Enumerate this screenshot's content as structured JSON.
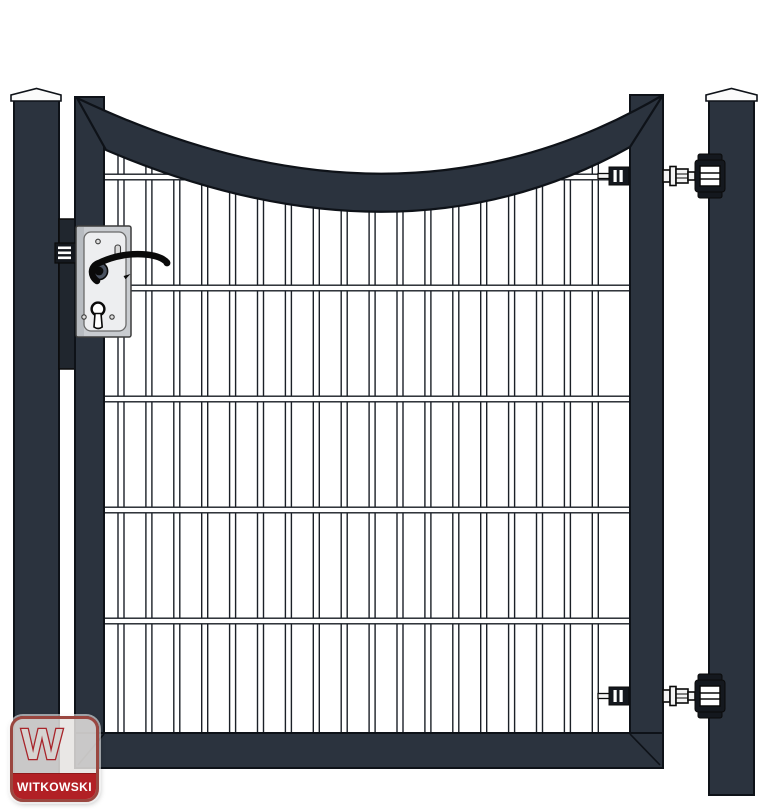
{
  "brand": {
    "name": "WITKOWSKI",
    "logo_letter": "W"
  },
  "scene": {
    "background": "#ffffff",
    "frame_color": "#2b333e",
    "outline_color": "#0e1218",
    "post_color": "#2b333e",
    "cap_color": "#fbfbfb",
    "mesh": {
      "vertical_bars": 18,
      "horizontal_rails": 5,
      "wire_fill": "#ffffff",
      "wire_outline": "#1b2027"
    },
    "lock": {
      "case_color": "#c9ccd0",
      "face_color": "#edeef0",
      "keep_color": "#20262e",
      "handle_color": "#0a0a0a"
    },
    "hinge": {
      "count": 2,
      "fill": "#f4f4f4",
      "dark": "#14181e",
      "outline": "#0a0a0a"
    },
    "logo_badge": {
      "band_color": "#b22025",
      "border_color": "#9a4740",
      "bg": "rgba(229,227,224,0.85)",
      "glyph_fill": "#d6d4d1",
      "glyph_outline": "#a8242a",
      "text_color": "#ffffff"
    }
  }
}
